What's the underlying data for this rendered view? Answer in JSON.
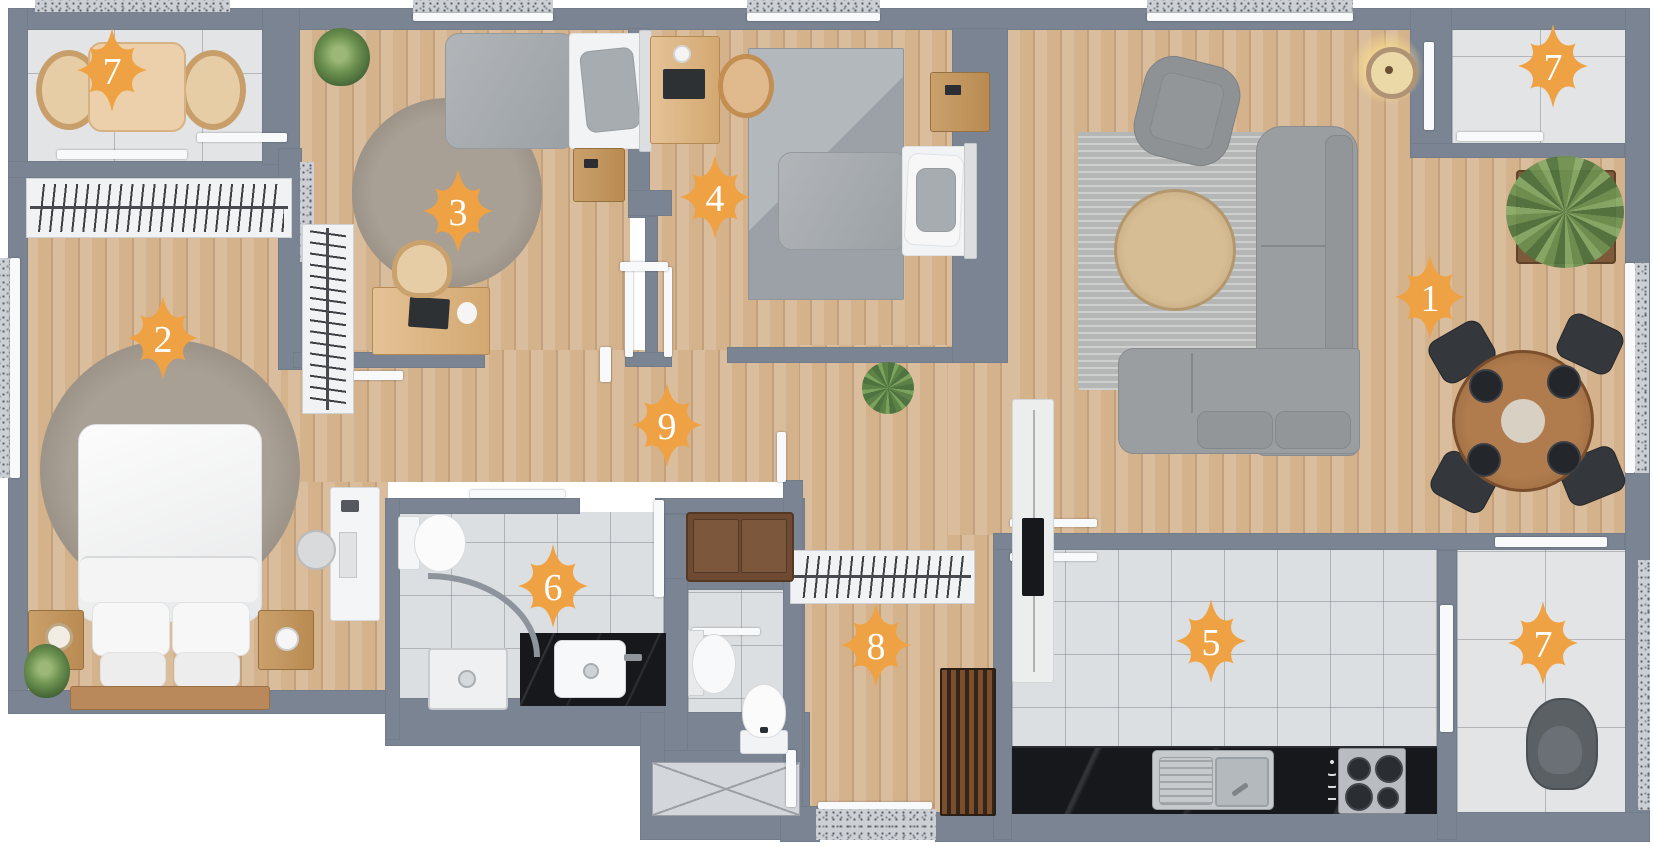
{
  "floorplan": {
    "canvas": {
      "width": 1653,
      "height": 846,
      "background": "#ffffff"
    },
    "colors": {
      "wall": "#7b8492",
      "wood_floor": "#d4b28c",
      "tile_floor": "#dcdfe1",
      "balcony_tile": "#e2e4e6",
      "counter_marble": "#17181c",
      "marker_fill": "#efa243",
      "marker_number": "#ffffff"
    },
    "marker_geometry": {
      "radius_vertical": 42,
      "radius_horizontal": 35,
      "radius_diagonal": 32,
      "radius_concave": 15,
      "font_size": 38
    },
    "markers": [
      {
        "room": "living-room",
        "number": "1",
        "x": 1430,
        "y": 297
      },
      {
        "room": "master-bedroom",
        "number": "2",
        "x": 163,
        "y": 338
      },
      {
        "room": "bedroom-2",
        "number": "3",
        "x": 458,
        "y": 211
      },
      {
        "room": "bedroom-3",
        "number": "4",
        "x": 715,
        "y": 197
      },
      {
        "room": "kitchen",
        "number": "5",
        "x": 1211,
        "y": 641
      },
      {
        "room": "bathroom",
        "number": "6",
        "x": 553,
        "y": 586
      },
      {
        "room": "balcony-top-left",
        "number": "7",
        "x": 112,
        "y": 70
      },
      {
        "room": "balcony-top-right",
        "number": "7",
        "x": 1553,
        "y": 66
      },
      {
        "room": "balcony-bottom-right",
        "number": "7",
        "x": 1543,
        "y": 643
      },
      {
        "room": "entrance-hall",
        "number": "8",
        "x": 876,
        "y": 645
      },
      {
        "room": "corridor",
        "number": "9",
        "x": 667,
        "y": 425
      }
    ]
  }
}
